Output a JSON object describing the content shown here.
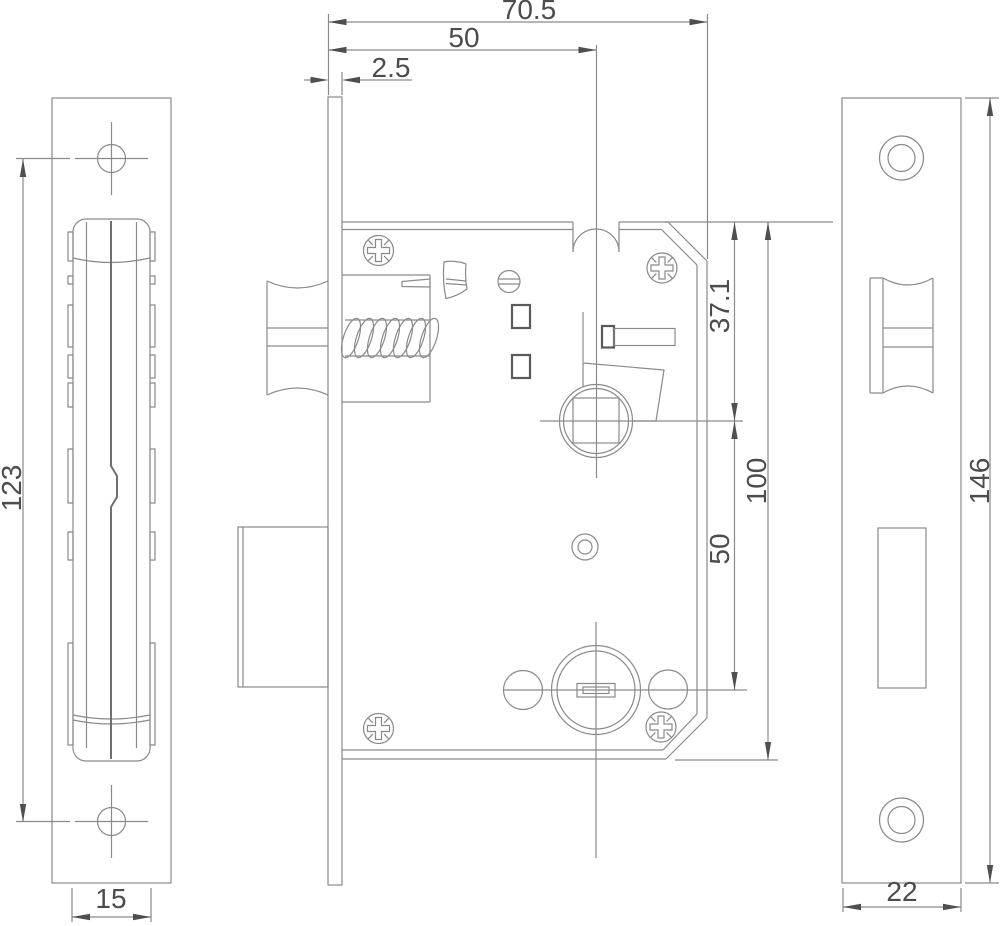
{
  "dims": {
    "total_depth": "70.5",
    "backset": "50",
    "faceplate_thickness": "2.5",
    "top_to_spindle": "37.1",
    "body_height": "100",
    "spindle_to_cylinder": "50",
    "screw_hole_spacing": "123",
    "latch_channel_width": "15",
    "plate_height": "146",
    "plate_width": "22"
  },
  "colors": {
    "line": "#8a8a8a",
    "dark": "#4f4f4f",
    "background": "#ffffff"
  }
}
